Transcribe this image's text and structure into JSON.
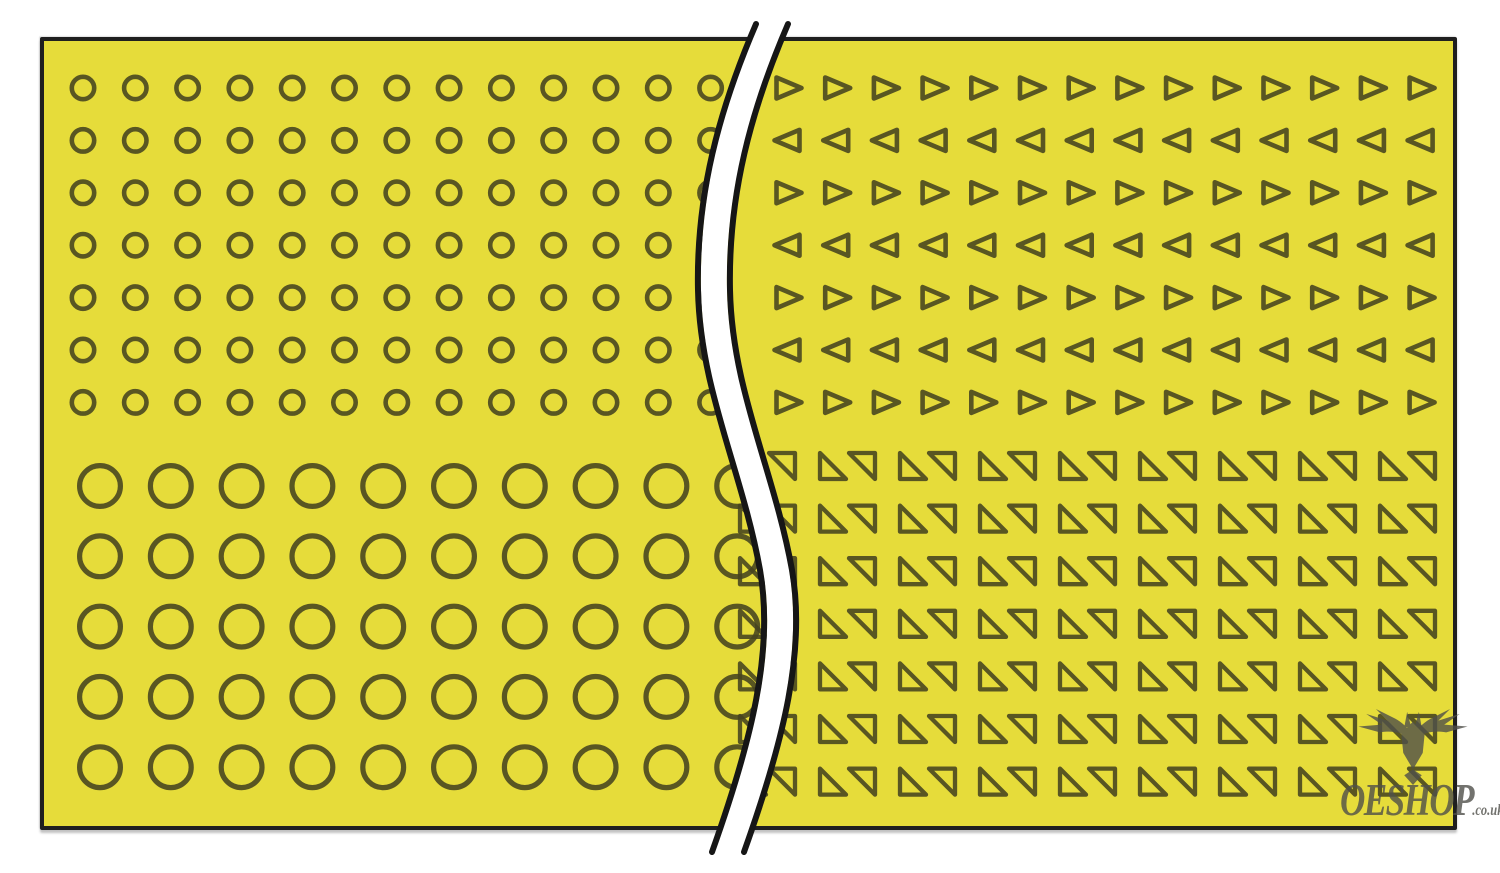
{
  "sheet": {
    "fill_color": "#e6dc3a",
    "border_color": "#1f1f1f",
    "outline_color": "#46431f",
    "outline_opacity": 0.88,
    "sections": [
      {
        "name": "top-left-small-circles",
        "shape": "ring",
        "x0": 83,
        "y0": 88,
        "dx": 52.3,
        "dy": 52.4,
        "cols": 13,
        "rows": 7,
        "r": 11.2,
        "stroke_width": 4.6
      },
      {
        "name": "bottom-left-large-circles",
        "shape": "ring",
        "x0": 100,
        "y0": 486,
        "dx": 70.8,
        "dy": 70.3,
        "cols": 10,
        "rows": 5,
        "r": 20.4,
        "stroke_width": 5.2
      },
      {
        "name": "top-right-small-triangles",
        "shape": "alt-triangles",
        "x0": 788,
        "y0": 88,
        "dx": 48.7,
        "dy": 52.4,
        "cols": 14,
        "rows": 7,
        "w": 23,
        "h": 21,
        "stroke_width": 4.6,
        "first_row_direction": "right"
      },
      {
        "name": "bottom-right-split-square-pairs",
        "shape": "split-square-pairs",
        "x0": 740,
        "y0": 453,
        "dx": 80,
        "dy": 52.6,
        "cols": 9,
        "rows": 7,
        "size": 26,
        "pair_offset": 29,
        "stroke_width": 4.3
      }
    ],
    "break_line": {
      "path": "M 772 24 C 735 110 712 195 714 290 C 716 390 758 470 776 570 C 790 650 768 740 728 852",
      "band_color": "#ffffff",
      "band_width": 26,
      "edge_color": "#161616",
      "edge_width": 6,
      "edge_offset": 16
    }
  },
  "watermark": {
    "brand": "OESHOP",
    "suffix": ".co.uk",
    "color": "#50504a",
    "icon": "stag-head-icon"
  }
}
